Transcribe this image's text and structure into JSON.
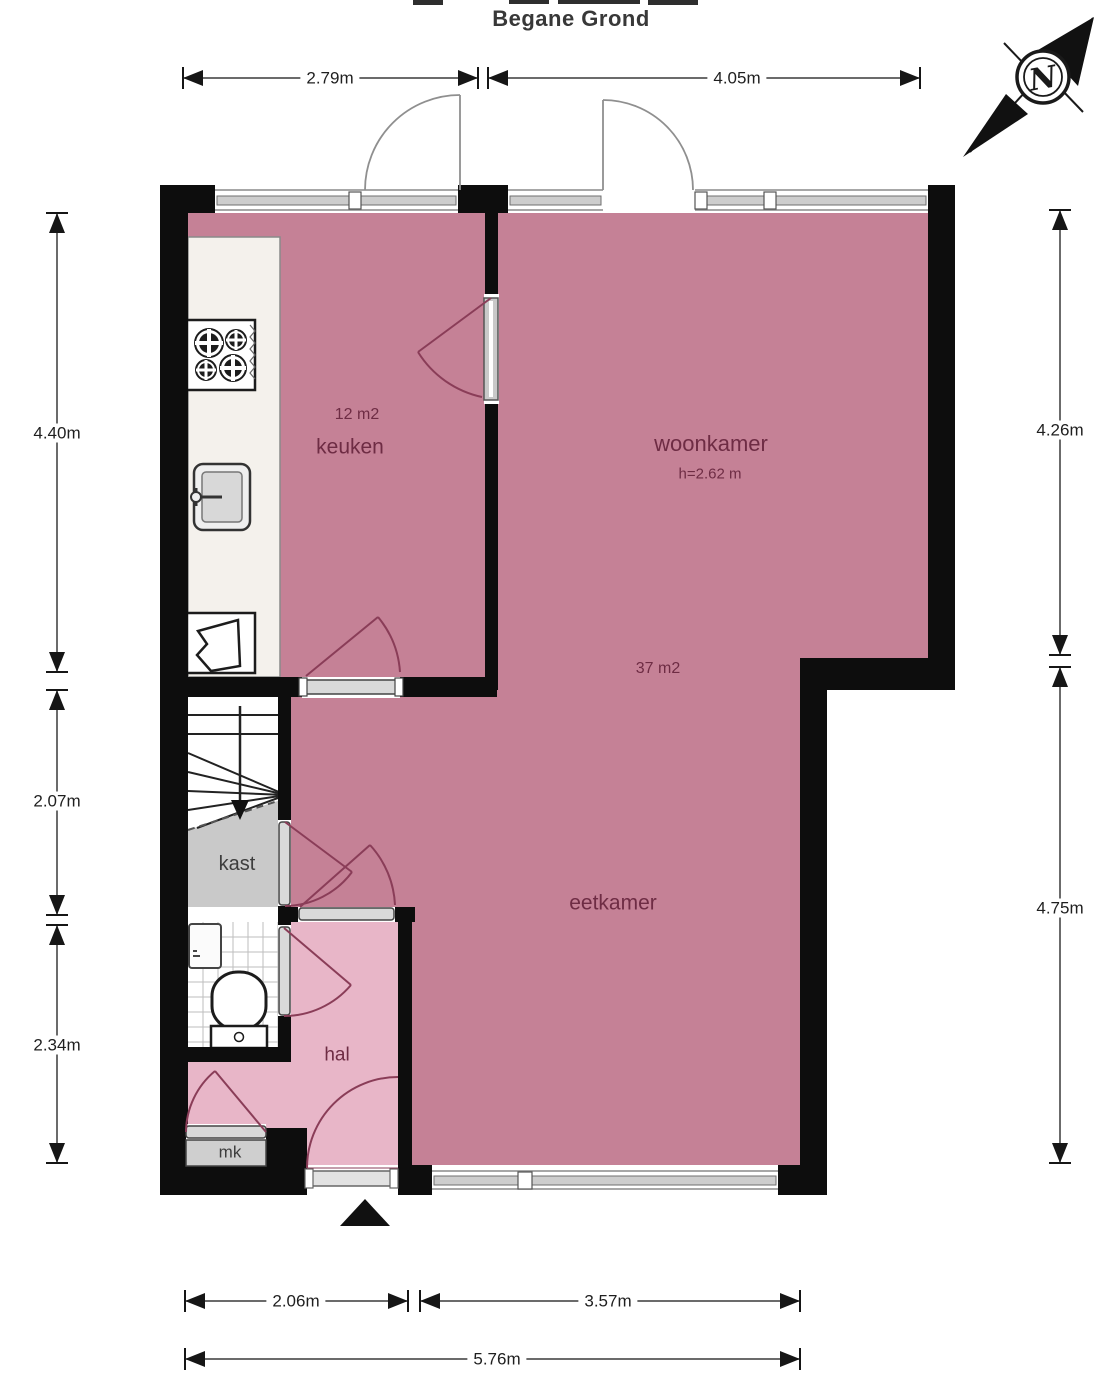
{
  "title": "Begane Grond",
  "compass": {
    "north_label": "N"
  },
  "rooms": {
    "keuken": {
      "label": "keuken",
      "area": "12 m2"
    },
    "woonkamer": {
      "label": "woonkamer",
      "ceiling_height": "h=2.62 m",
      "area": "37 m2"
    },
    "eetkamer": {
      "label": "eetkamer"
    },
    "kast": {
      "label": "kast"
    },
    "hal": {
      "label": "hal"
    },
    "mk": {
      "label": "mk"
    }
  },
  "dimensions": {
    "top": [
      "2.79m",
      "4.05m"
    ],
    "left": [
      "4.40m",
      "2.07m",
      "2.34m"
    ],
    "right": [
      "4.26m",
      "4.75m"
    ],
    "bottom": [
      "2.06m",
      "3.57m",
      "5.76m"
    ]
  },
  "colors": {
    "room_fill": "#c58196",
    "hall_fill": "#e8b6c8",
    "closet_fill": "#c9c9c9",
    "wall": "#0d0d0d",
    "room_label_text": "#6e2c44",
    "dimension_text": "#1f1f1f"
  }
}
